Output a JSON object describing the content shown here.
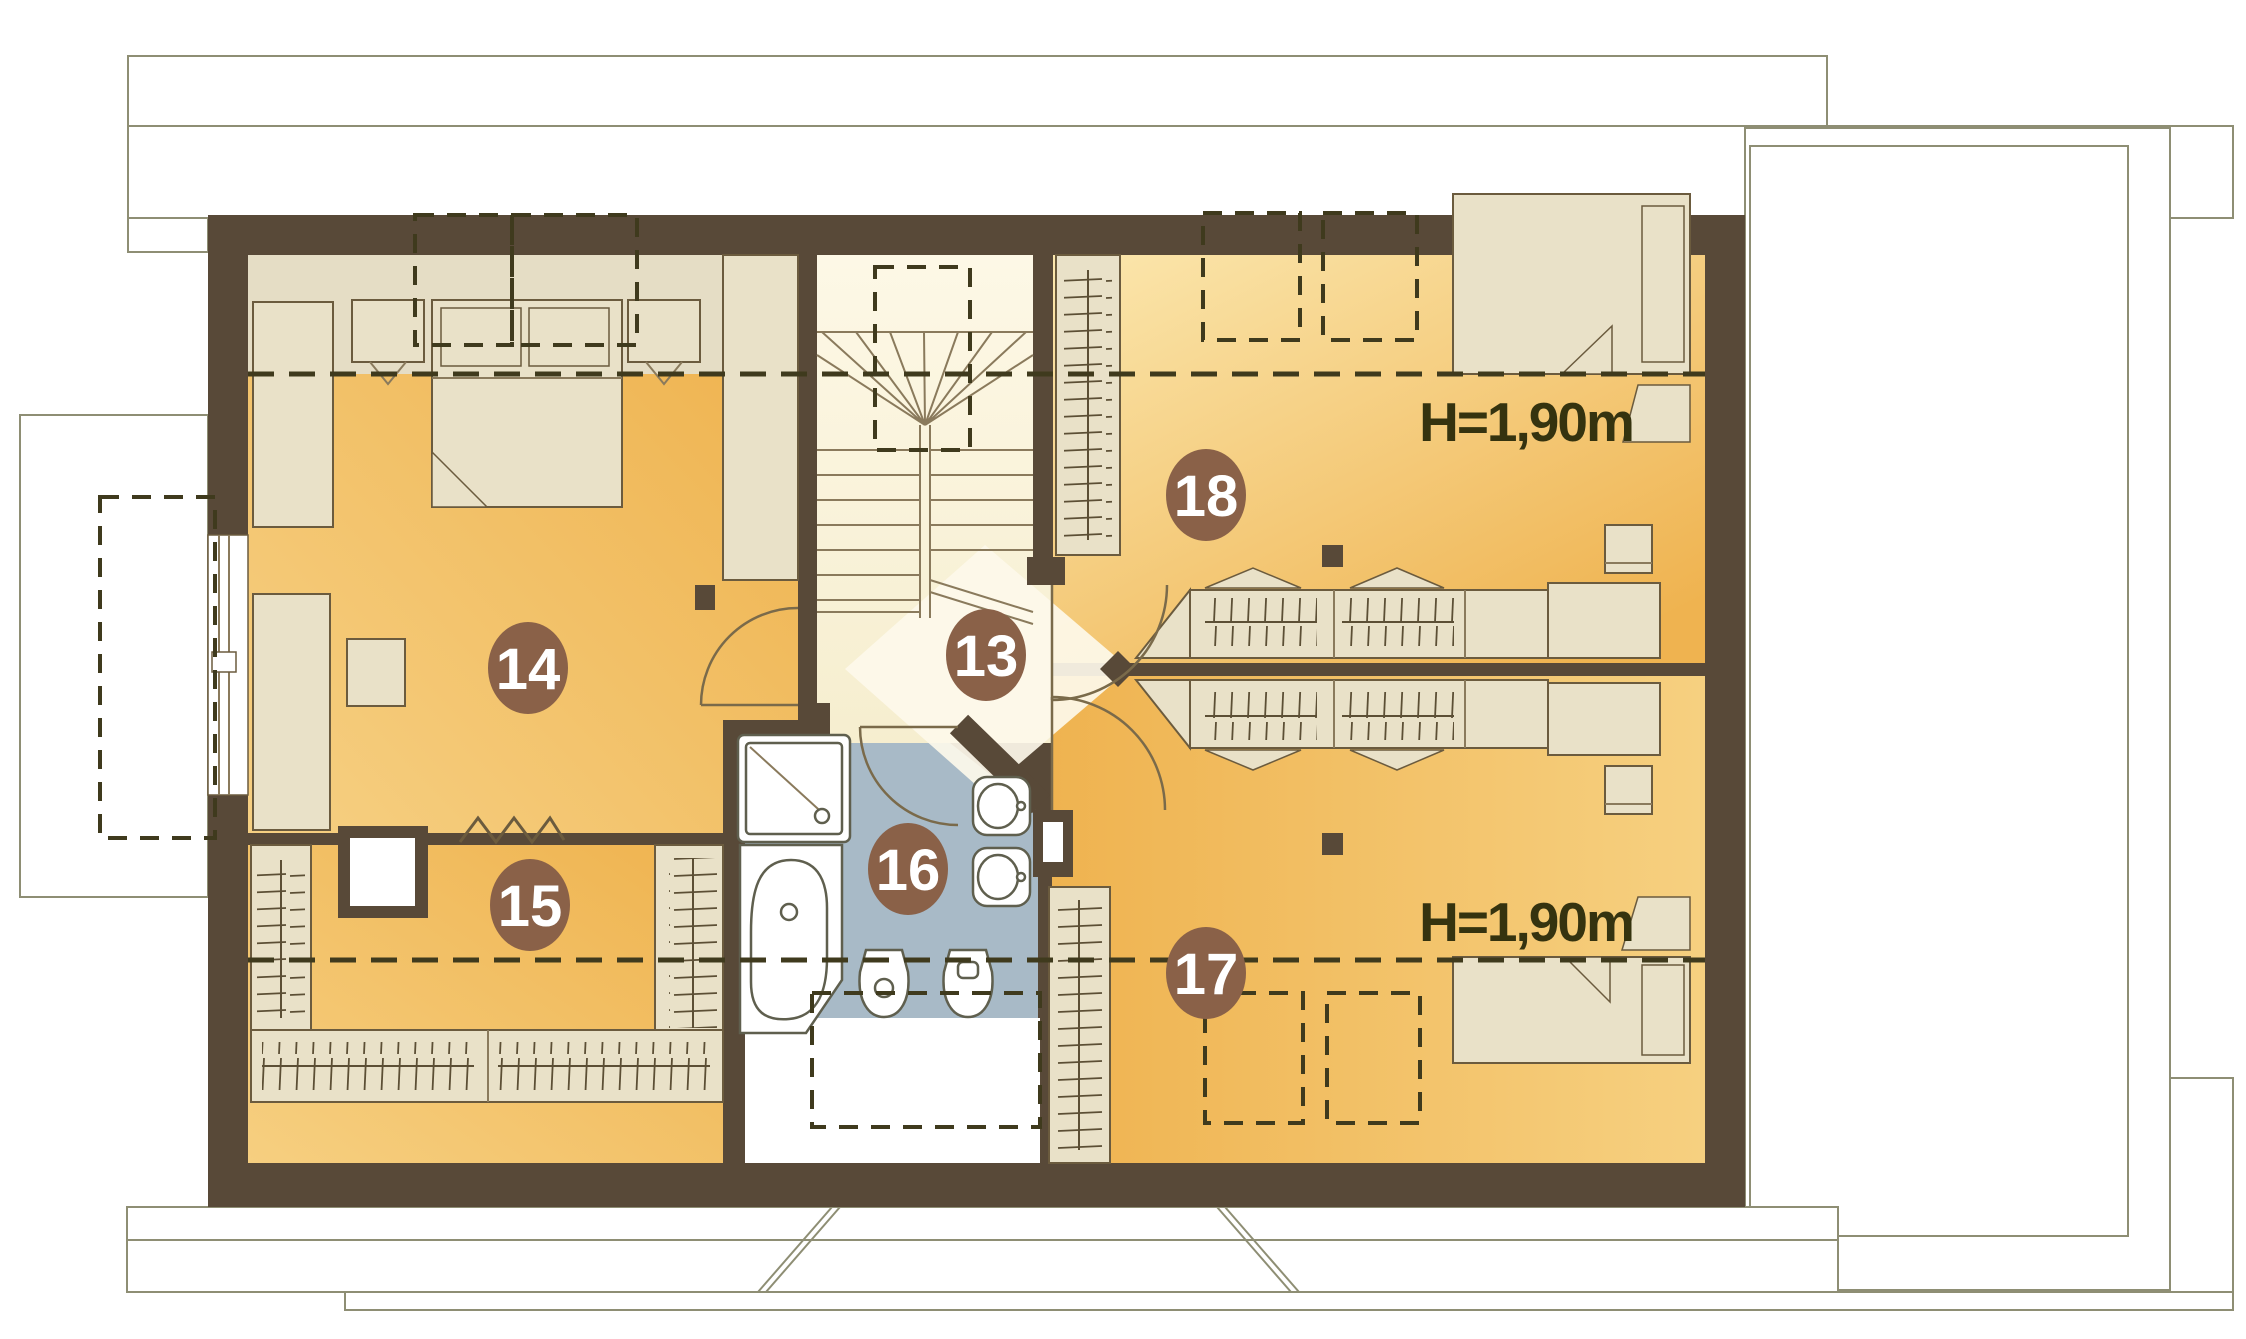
{
  "plan": {
    "type": "attic-floor-plan",
    "rooms": {
      "r13": {
        "number": "13"
      },
      "r14": {
        "number": "14"
      },
      "r15": {
        "number": "15"
      },
      "r16": {
        "number": "16"
      },
      "r17": {
        "number": "17"
      },
      "r18": {
        "number": "18"
      }
    },
    "labels": {
      "height_north": "H=1,90m",
      "height_south": "H=1,90m"
    },
    "colors": {
      "wall": "#584938",
      "badge": "#8a6148",
      "floor_orange": "#efb350",
      "floor_orange_light": "#f7d88e",
      "floor_pale": "#f8f1d7",
      "bathroom_blue": "#a8bac7",
      "furniture_tan": "#e9e1c8",
      "low_zone_tan": "#e5ddc5",
      "outline": "#8e8e74",
      "dashed": "#3f3a1d",
      "label_text": "#35330f"
    }
  }
}
